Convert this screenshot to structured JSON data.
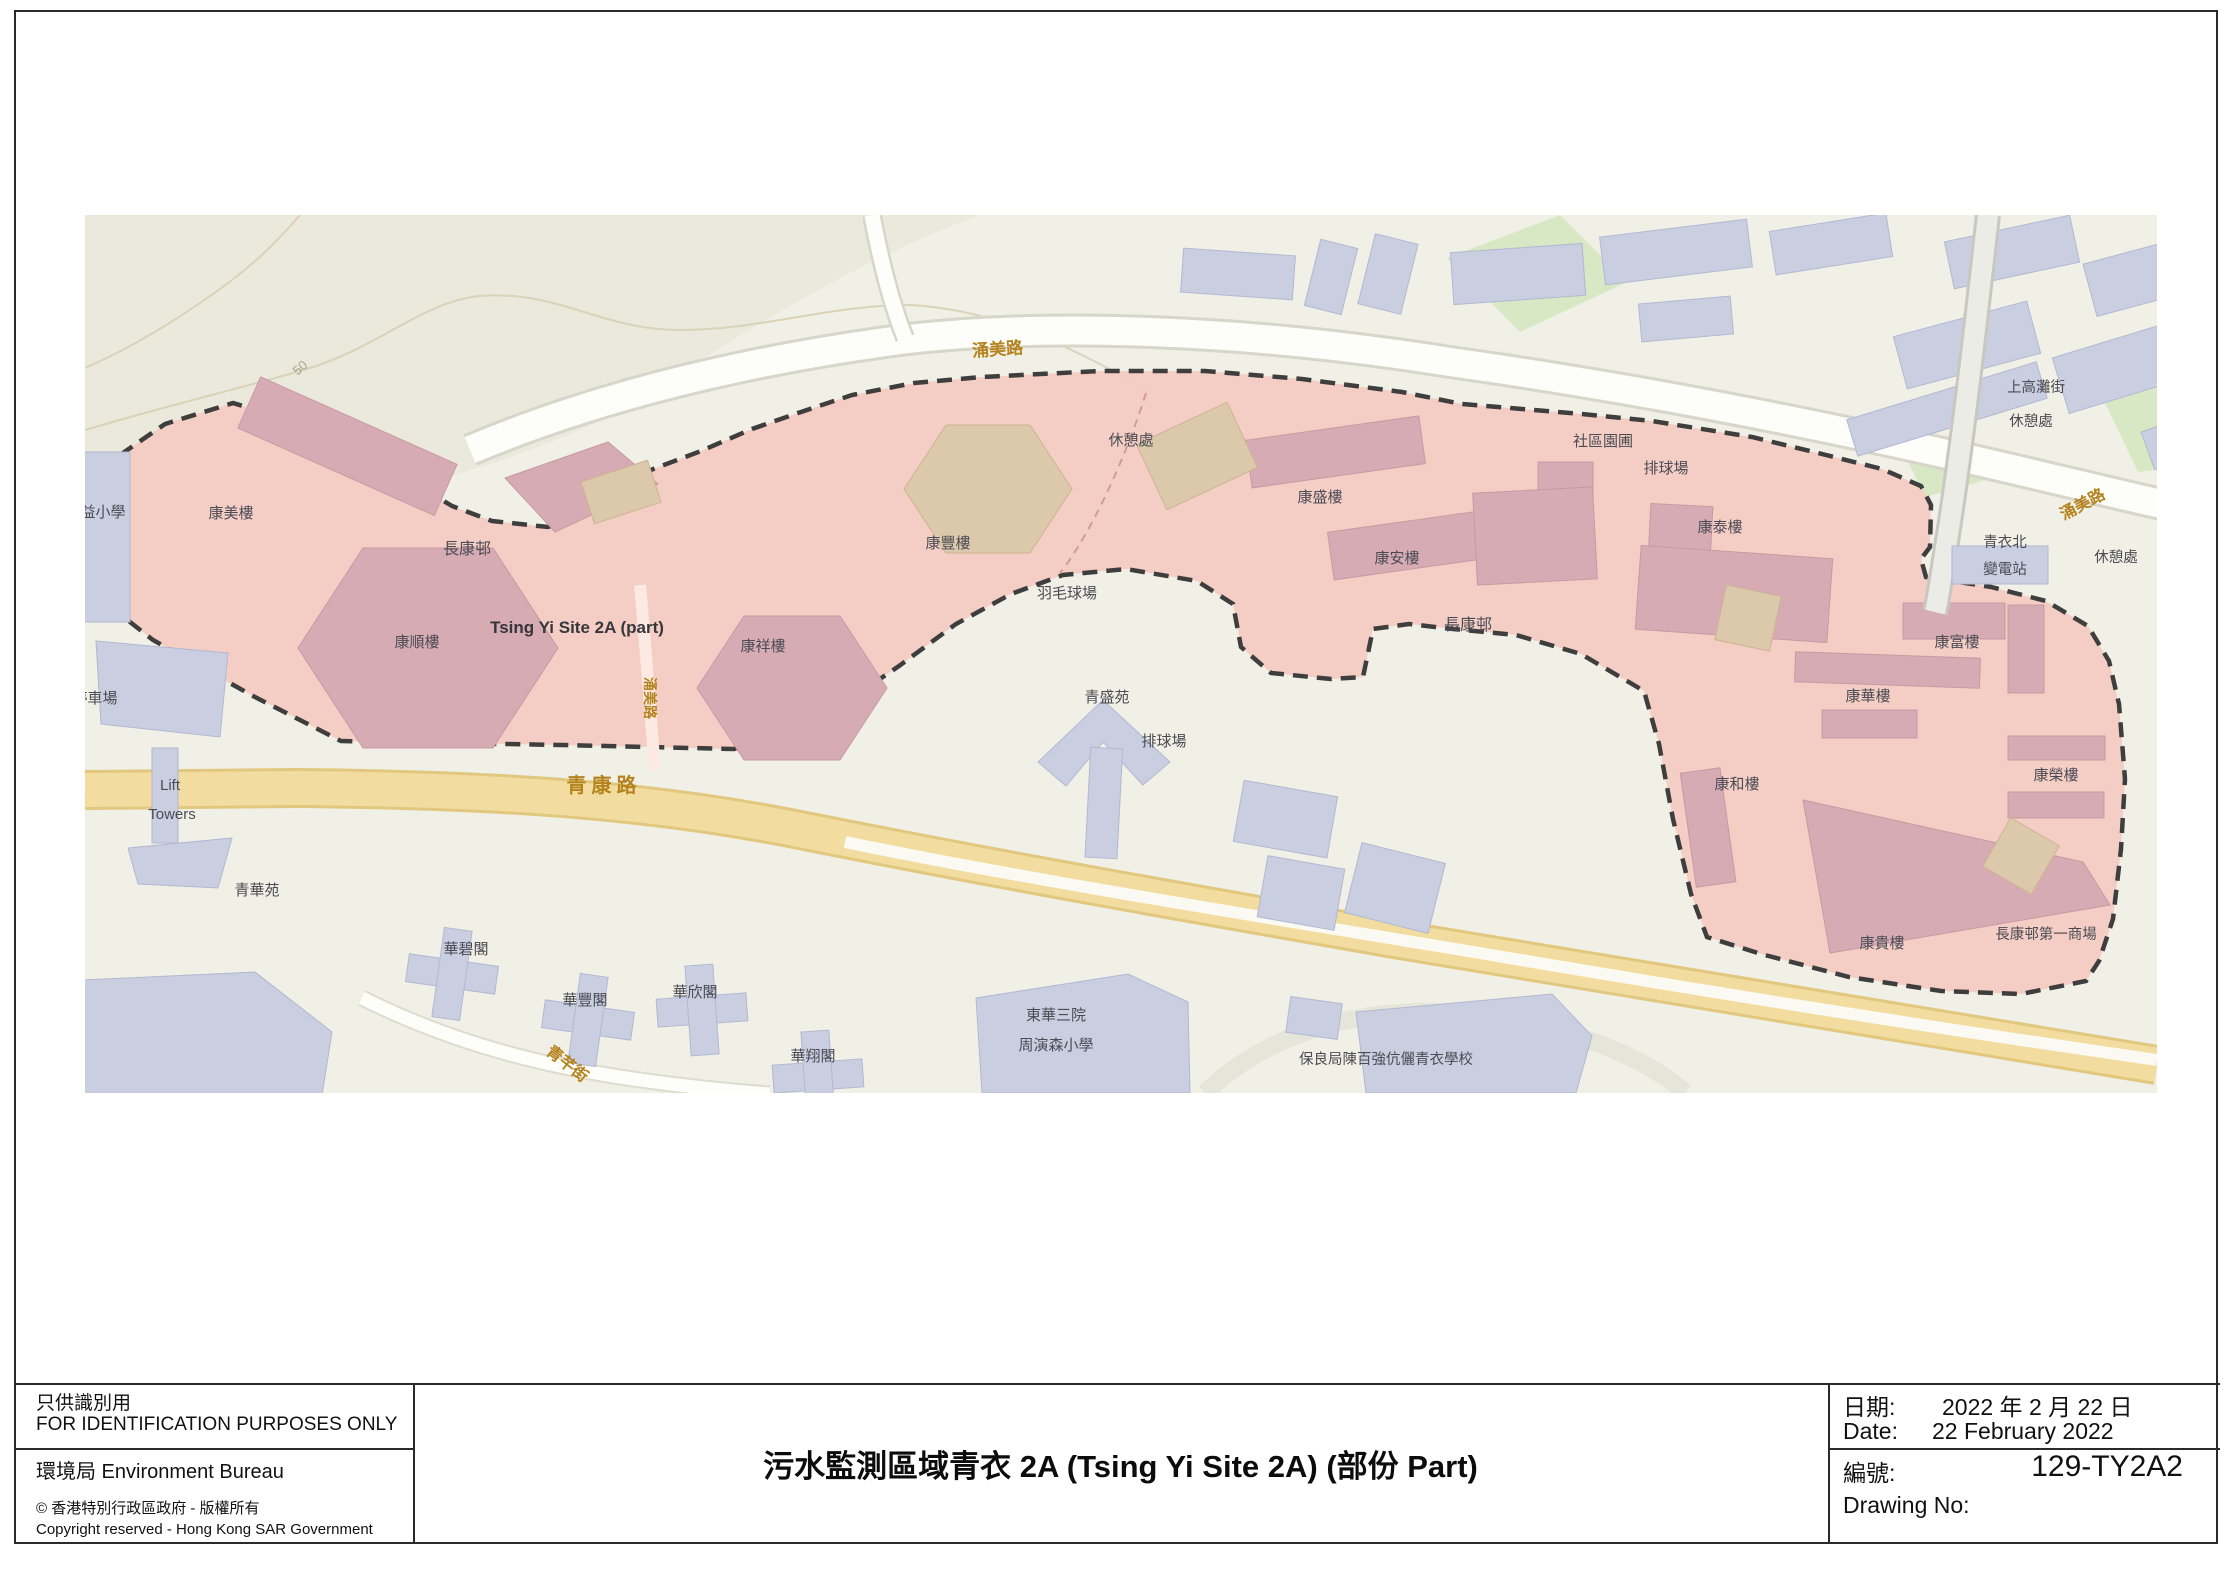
{
  "page": {
    "stamp": {
      "zh": "只供識別用",
      "en": "FOR IDENTIFICATION PURPOSES ONLY"
    },
    "bureau": "環境局  Environment Bureau",
    "copyright_zh": "© 香港特別行政區政府 - 版權所有",
    "copyright_en": "Copyright reserved - Hong Kong SAR Government",
    "title": "污水監測區域青衣 2A (Tsing Yi Site 2A) (部份 Part)",
    "date": {
      "zh_label": "日期:",
      "zh_value": "2022 年 2 月 22 日",
      "en_label": "Date:",
      "en_value": "22 February 2022"
    },
    "drawing": {
      "zh_label": "編號:",
      "value": "129-TY2A2",
      "en_label": "Drawing No:"
    }
  },
  "map": {
    "site_name": "Tsing Yi Site 2A (part)",
    "colors": {
      "zone_fill": "#f4cbc2",
      "zone_boundary": "#3e3e3e",
      "road_yellow": "#f2dca0",
      "building_in_zone": "#d7abb3",
      "building_outside": "#c9cee1",
      "road_label": "#b5831d",
      "building_label": "#4b4b54"
    },
    "labels": [
      {
        "t": "停車場",
        "x": 95,
        "y": 703,
        "s": 15,
        "c": "b"
      },
      {
        "t": "益小學",
        "x": 103,
        "y": 517,
        "s": 15,
        "c": "b"
      },
      {
        "t": "康美樓",
        "x": 231,
        "y": 518,
        "s": 15,
        "c": "b"
      },
      {
        "t": "長康邨",
        "x": 467,
        "y": 554,
        "s": 16,
        "c": "b"
      },
      {
        "t": "康順樓",
        "x": 417,
        "y": 647,
        "s": 15,
        "c": "b"
      },
      {
        "t": "Tsing Yi Site 2A (part)",
        "x": 577,
        "y": 633,
        "s": 17,
        "c": "site"
      },
      {
        "t": "康豐樓",
        "x": 948,
        "y": 548,
        "s": 15,
        "c": "b"
      },
      {
        "t": "康祥樓",
        "x": 763,
        "y": 651,
        "s": 15,
        "c": "b"
      },
      {
        "t": "羽毛球場",
        "x": 1067,
        "y": 598,
        "s": 15,
        "c": "b"
      },
      {
        "t": "休憩處",
        "x": 1131,
        "y": 445,
        "s": 15,
        "c": "b"
      },
      {
        "t": "康盛樓",
        "x": 1320,
        "y": 502,
        "s": 15,
        "c": "b"
      },
      {
        "t": "康安樓",
        "x": 1397,
        "y": 563,
        "s": 15,
        "c": "b"
      },
      {
        "t": "青盛苑",
        "x": 1107,
        "y": 702,
        "s": 15,
        "c": "b"
      },
      {
        "t": "排球場",
        "x": 1164,
        "y": 746,
        "s": 15,
        "c": "b"
      },
      {
        "t": "社區園圃",
        "x": 1603,
        "y": 446,
        "s": 15,
        "c": "b"
      },
      {
        "t": "排球場",
        "x": 1666,
        "y": 473,
        "s": 15,
        "c": "b"
      },
      {
        "t": "康泰樓",
        "x": 1720,
        "y": 532,
        "s": 15,
        "c": "b"
      },
      {
        "t": "長康邨",
        "x": 1468,
        "y": 630,
        "s": 16,
        "c": "b"
      },
      {
        "t": "康富樓",
        "x": 1957,
        "y": 647,
        "s": 15,
        "c": "b"
      },
      {
        "t": "康華樓",
        "x": 1868,
        "y": 701,
        "s": 15,
        "c": "b"
      },
      {
        "t": "康和樓",
        "x": 1737,
        "y": 789,
        "s": 15,
        "c": "b"
      },
      {
        "t": "康榮樓",
        "x": 2056,
        "y": 780,
        "s": 15,
        "c": "b"
      },
      {
        "t": "康貴樓",
        "x": 1882,
        "y": 948,
        "s": 15,
        "c": "b"
      },
      {
        "t": "長康邨第一商場",
        "x": 2046,
        "y": 939,
        "s": 14.5,
        "c": "b"
      },
      {
        "t": "青華苑",
        "x": 257,
        "y": 895,
        "s": 15,
        "c": "b"
      },
      {
        "t": "Lift",
        "x": 170,
        "y": 790,
        "s": 15,
        "c": "b"
      },
      {
        "t": "Towers",
        "x": 172,
        "y": 819,
        "s": 15,
        "c": "b"
      },
      {
        "t": "東華三院",
        "x": 1056,
        "y": 1020,
        "s": 15,
        "c": "b"
      },
      {
        "t": "周演森小學",
        "x": 1056,
        "y": 1050,
        "s": 15,
        "c": "b"
      },
      {
        "t": "保良局陳百強伉儷青衣學校",
        "x": 1386,
        "y": 1064,
        "s": 14.5,
        "c": "b"
      },
      {
        "t": "上高灘街",
        "x": 2036,
        "y": 392,
        "s": 14.5,
        "c": "b"
      },
      {
        "t": "休憩處",
        "x": 2031,
        "y": 426,
        "s": 14.5,
        "c": "b"
      },
      {
        "t": "青衣北",
        "x": 2005,
        "y": 547,
        "s": 14.5,
        "c": "b"
      },
      {
        "t": "變電站",
        "x": 2005,
        "y": 574,
        "s": 14.5,
        "c": "b"
      },
      {
        "t": "休憩處",
        "x": 2116,
        "y": 562,
        "s": 14.5,
        "c": "b"
      },
      {
        "t": "華碧閣",
        "x": 466,
        "y": 954,
        "s": 15,
        "c": "b"
      },
      {
        "t": "華豐閣",
        "x": 585,
        "y": 1005,
        "s": 15,
        "c": "b"
      },
      {
        "t": "華欣閣",
        "x": 695,
        "y": 997,
        "s": 15,
        "c": "b"
      },
      {
        "t": "華翔閣",
        "x": 813,
        "y": 1061,
        "s": 15,
        "c": "b"
      },
      {
        "t": "涌美路",
        "x": 998,
        "y": 355,
        "s": 17,
        "c": "road",
        "r": -4
      },
      {
        "t": "涌美路",
        "x": 2085,
        "y": 509,
        "s": 16,
        "c": "road",
        "r": -28
      },
      {
        "t": "涌美路",
        "x": 645,
        "y": 698,
        "s": 14,
        "c": "road",
        "r": 90
      },
      {
        "t": "青康路",
        "x": 604,
        "y": 792,
        "s": 20,
        "c": "road",
        "ls": 5
      },
      {
        "t": "青芊街",
        "x": 564,
        "y": 1068,
        "s": 16,
        "c": "road",
        "r": 38
      },
      {
        "t": "50",
        "x": 303,
        "y": 371,
        "s": 13,
        "c": "cont",
        "r": -42
      }
    ]
  }
}
